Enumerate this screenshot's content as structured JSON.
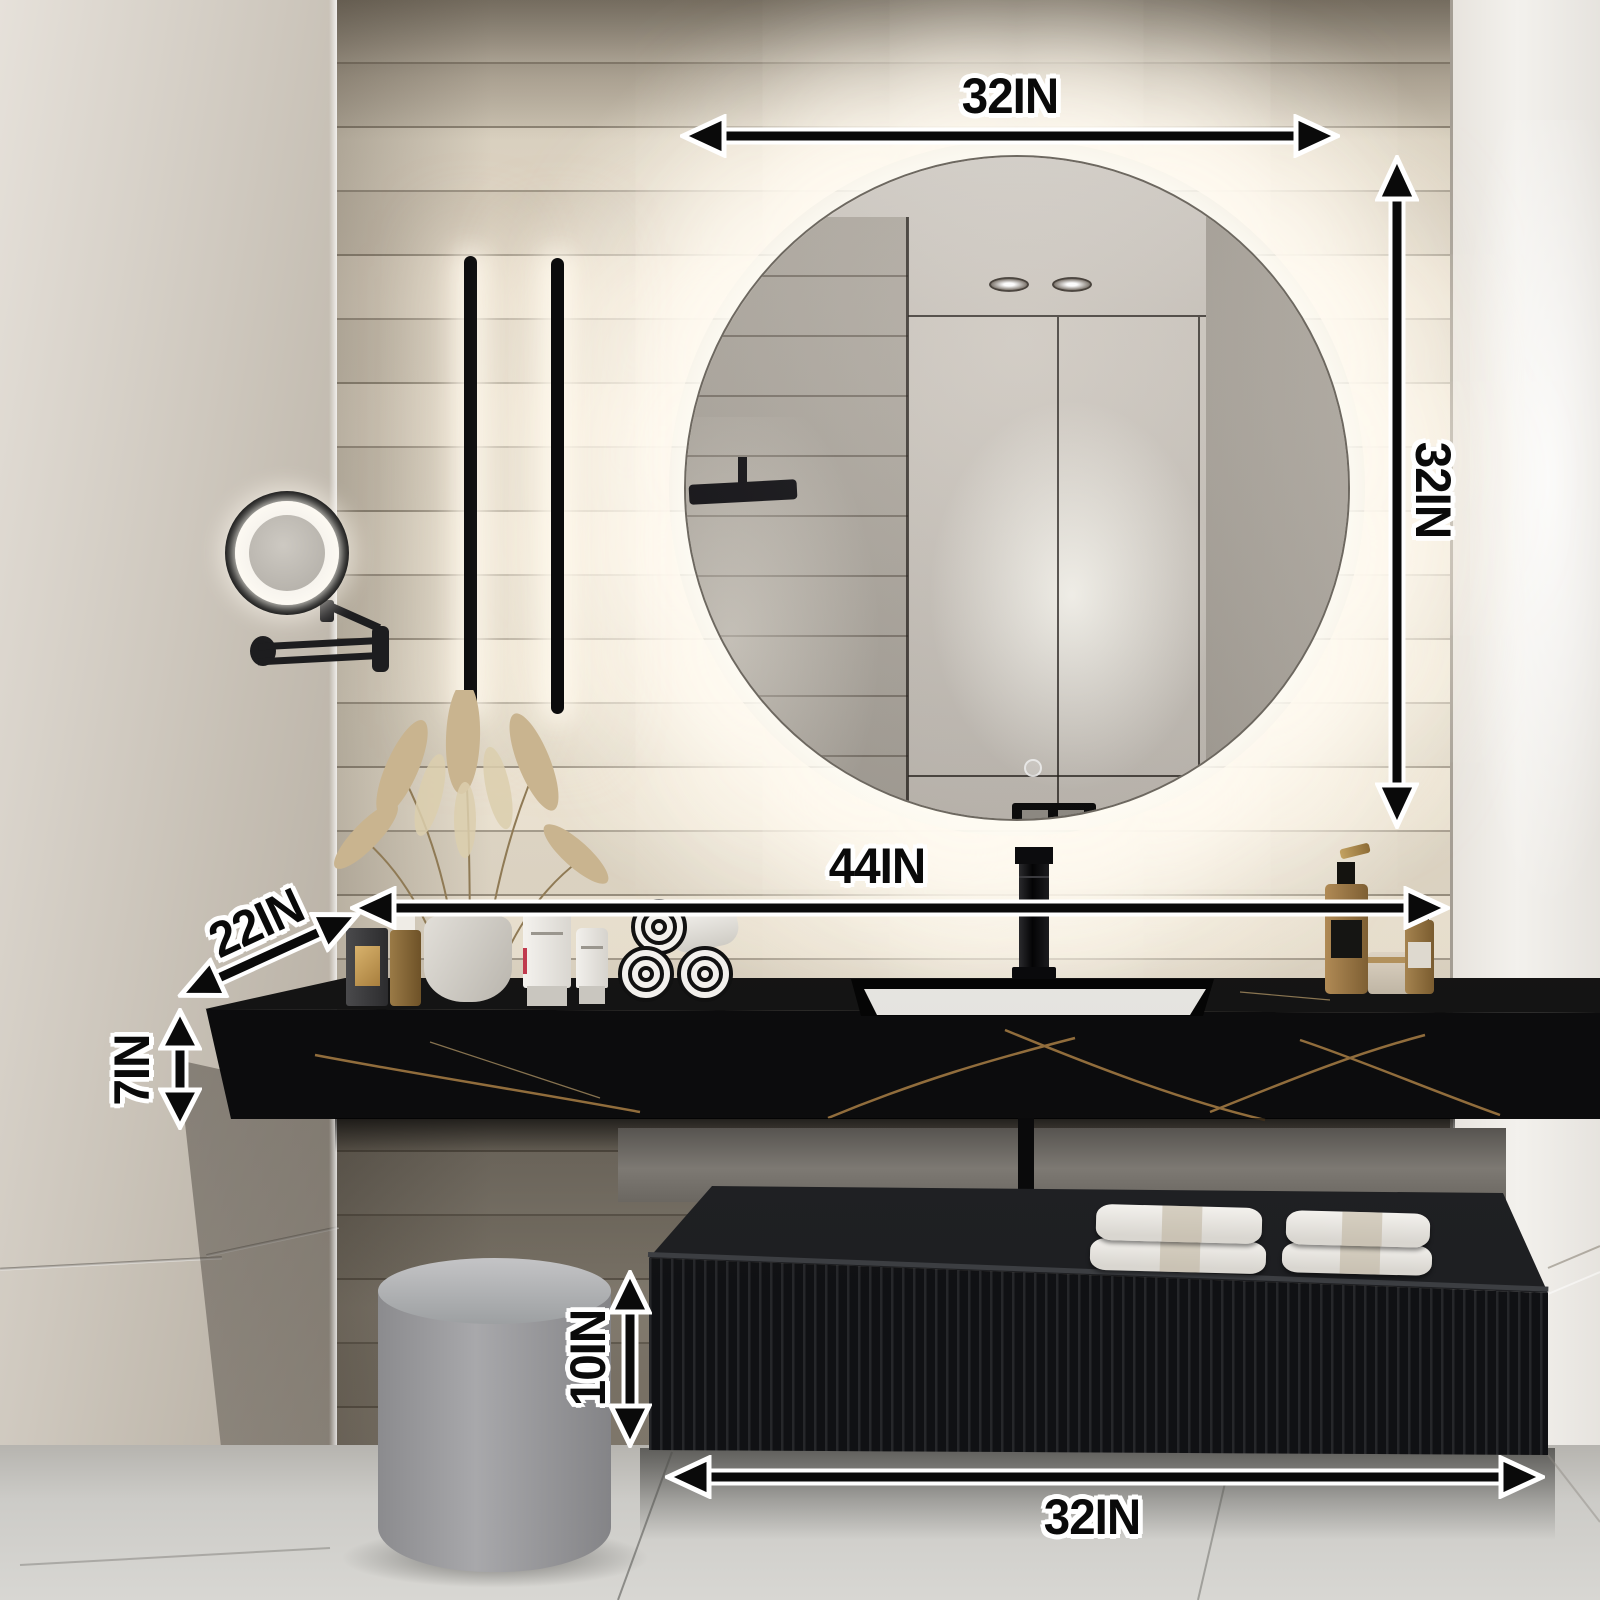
{
  "title": "Bathroom vanity with LED round mirror — dimension illustration",
  "annotations": {
    "mirror_width": "32IN",
    "mirror_height": "32IN",
    "countertop_width": "44IN",
    "countertop_depth": "22IN",
    "countertop_thickness": "7IN",
    "drawer_height": "10IN",
    "cabinet_width": "32IN"
  },
  "colors": {
    "arrow_fill": "#0a0a0a",
    "arrow_outline": "#ffffff",
    "label_text": "#0a0a0a",
    "label_halo": "#ffffff",
    "countertop_black": "#0d0d0e",
    "marble_vein_gold": "#b08a50",
    "cabinet_black": "#1a1b1e",
    "wall_beige": "#e5dbc9",
    "backlight_glow": "#fff8eb",
    "sink_white": "#f5f4f1",
    "stool_gray": "#9b9b9e",
    "floor_gray": "#cfcec9"
  }
}
